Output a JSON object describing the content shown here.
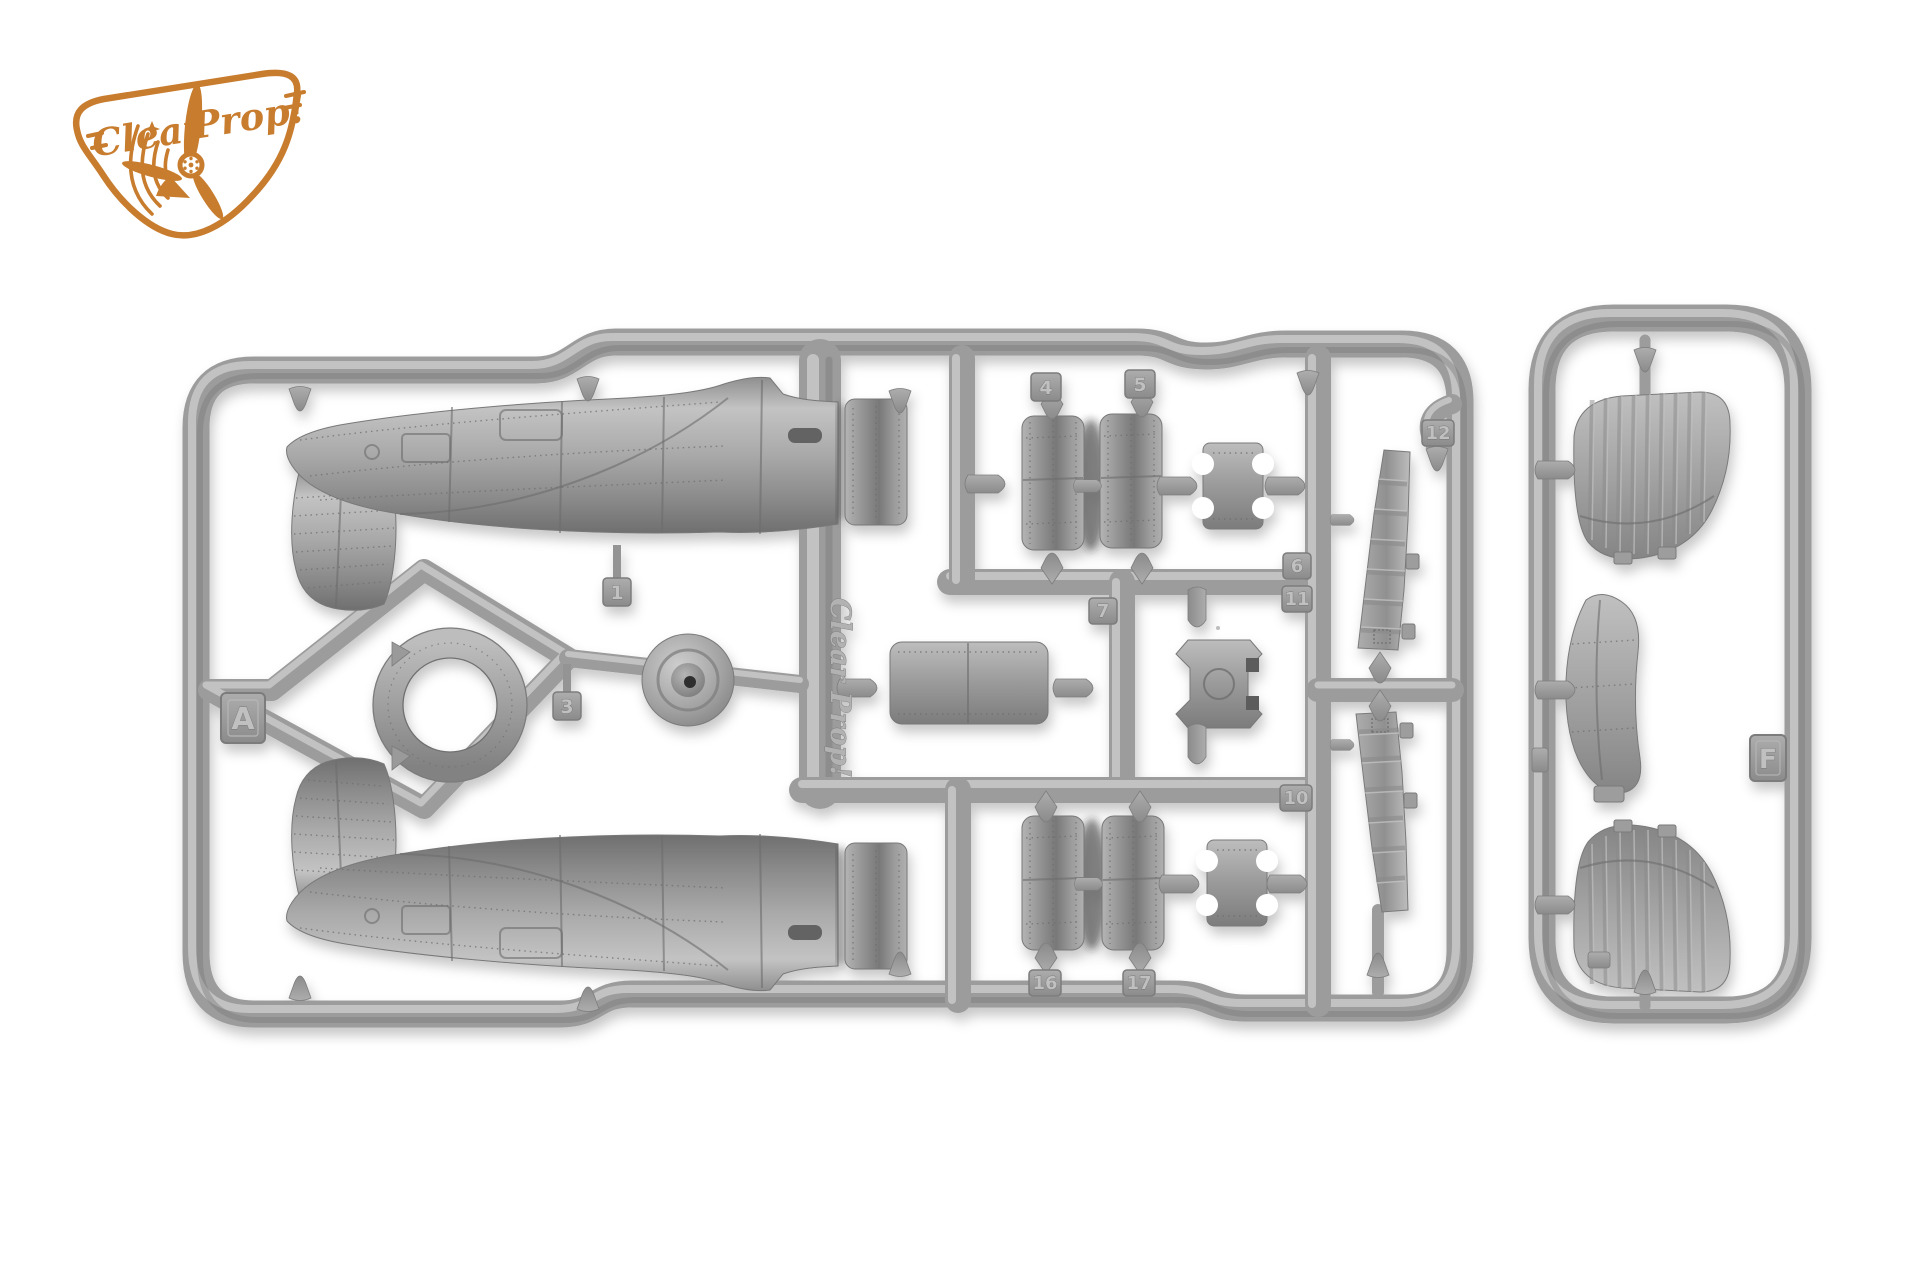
{
  "logo": {
    "word1": "Clear",
    "word2": "Prop!",
    "color": "#c87c2e"
  },
  "molding": {
    "brand_script": "Clear Prop!"
  },
  "sprue_a": {
    "letter": "A",
    "tags": {
      "p1": "1",
      "p3": "3",
      "p4": "4",
      "p5": "5",
      "p6": "6",
      "p7": "7",
      "p10": "10",
      "p11": "11",
      "p12": "12",
      "p16": "16",
      "p17": "17"
    }
  },
  "sprue_f": {
    "letter": "F"
  },
  "colors": {
    "background": "#ffffff",
    "plastic_base": "#9c9c9c",
    "plastic_light": "#cacaca",
    "plastic_dark": "#707070",
    "logo_orange": "#c87c2e"
  }
}
